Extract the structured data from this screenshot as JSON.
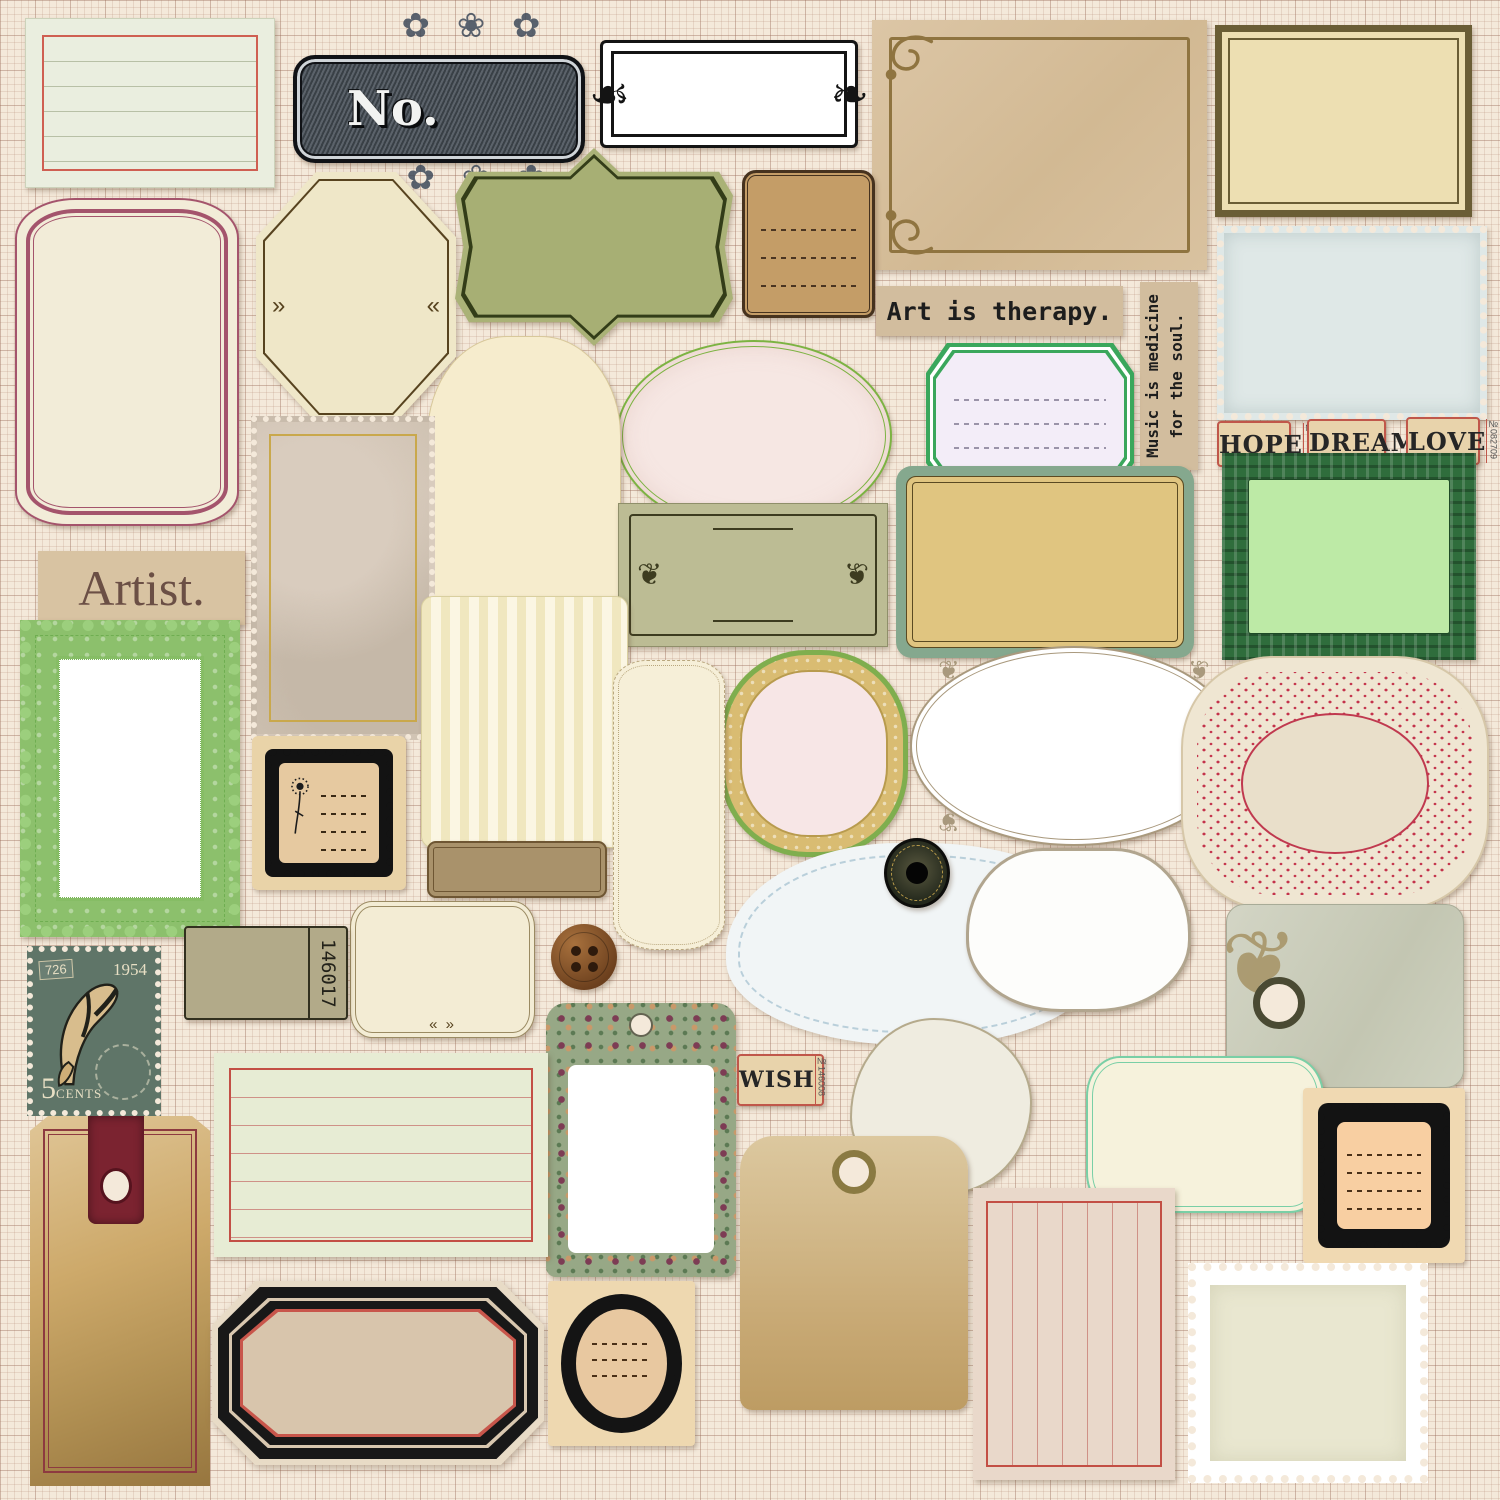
{
  "palette": {
    "page_bg": "#f4e9da",
    "grid_line": "#b58a70",
    "red_accent": "#c65a4f",
    "maroon": "#a4546c",
    "sage_green": "#aab277",
    "olive_khaki": "#b2aa89",
    "kraft_tan": "#d2bd9e",
    "teal_green": "#85a88e",
    "banknote_green": "#2f6d3c",
    "lace_green": "#8cc06c",
    "stamp_blue": "#dfe8e7",
    "wood": "#eed8b0",
    "ink_black": "#161616",
    "leather_maroon": "#7b2330"
  },
  "texts": {
    "no_plate": "No.",
    "art_strip": "Art is therapy.",
    "music_strip": "Music is medicine for the soul.",
    "artist_strip": "Artist.",
    "tickets": [
      {
        "word": "HOPE",
        "number": "№403548"
      },
      {
        "word": "DREAM",
        "number": "№540688"
      },
      {
        "word": "LOVE",
        "number": "№082709"
      }
    ],
    "wish_ticket": {
      "word": "WISH",
      "number": "№146008"
    },
    "olive_ticket_number": "146017",
    "butterfly_stamp": {
      "corner_number": "726",
      "year": "1954",
      "value": "5",
      "unit": "CENTS"
    }
  },
  "ornaments": {
    "floral_cluster": "✿ ❀ ✿",
    "scroll_left": "☙",
    "scroll_right": "❧",
    "fleuron": "❦",
    "arrow_left": "«",
    "arrow_right": "»",
    "bracket_arrows": "« »"
  }
}
